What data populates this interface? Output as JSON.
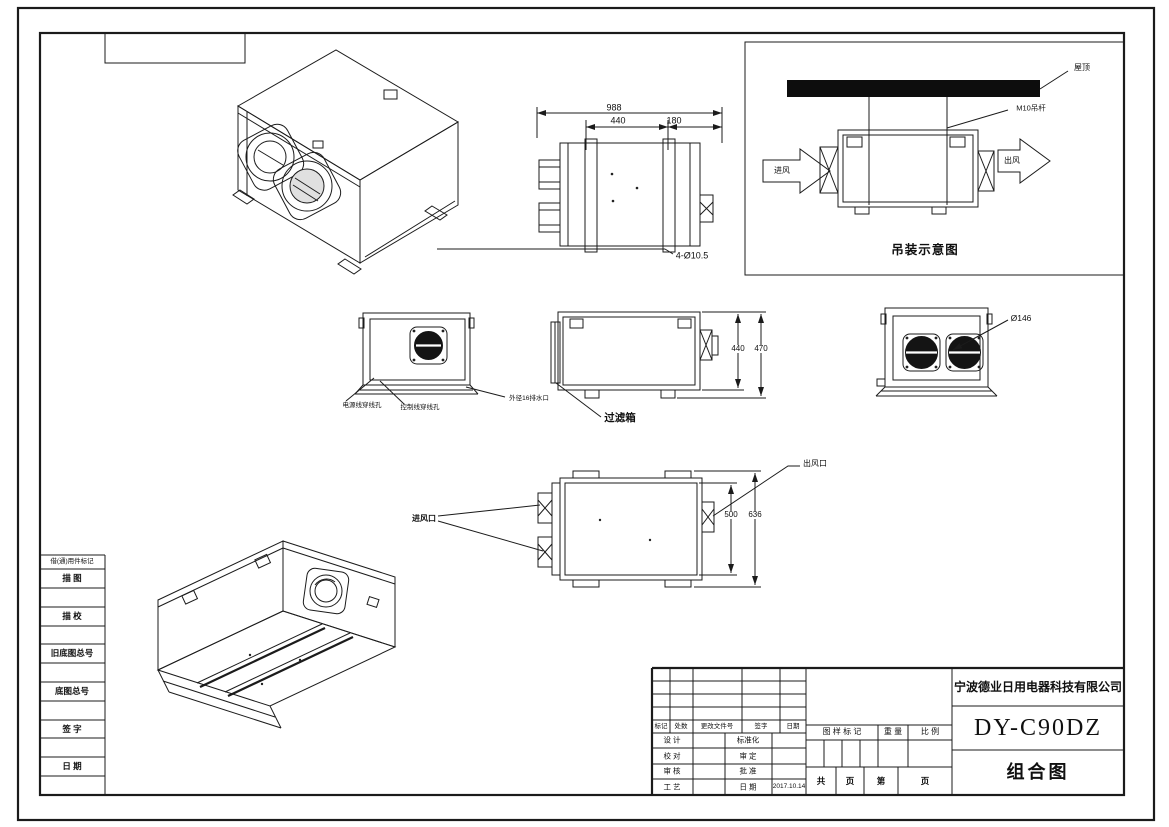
{
  "sheet": {
    "background": "#ffffff",
    "ink": "#1b1b1b"
  },
  "top_view": {
    "dim_overall": "988",
    "dim_body": "440",
    "dim_end": "180",
    "hole_callout": "4-Ø10.5"
  },
  "hanging_diagram": {
    "caption": "吊装示意图",
    "roof_label": "屋顶",
    "rod_label": "M10吊杆",
    "inlet_label": "进风",
    "outlet_label": "出风"
  },
  "front_view_labels": {
    "power_hole": "电源线穿线孔",
    "control_hole": "控制线穿线孔",
    "drain": "外径16排水口"
  },
  "side_view": {
    "dim_body": "440",
    "dim_overall": "470",
    "filter_box": "过滤箱"
  },
  "rear_view": {
    "port_diameter": "Ø146"
  },
  "plan_view": {
    "inlet_label": "进风口",
    "outlet_label": "出风口",
    "dim_body": "500",
    "dim_overall": "636"
  },
  "left_margin": {
    "rows": [
      "借(通)用件标记",
      "描  图",
      "描  校",
      "旧底图总号",
      "底图总号",
      "签  字",
      "日  期"
    ]
  },
  "title_block": {
    "revision_header": {
      "mark": "标记",
      "count": "处数",
      "doc_no": "更改文件号",
      "sign": "签字",
      "date": "日期"
    },
    "approval_rows": [
      {
        "left": "设 计",
        "right": "标准化",
        "value": ""
      },
      {
        "left": "校 对",
        "right": "审 定",
        "value": ""
      },
      {
        "left": "审 核",
        "right": "批 准",
        "value": ""
      },
      {
        "left": "工 艺",
        "right": "日 期",
        "value": "2017.10.14"
      }
    ],
    "stamp_header": {
      "mark": "图 样 标 记",
      "weight": "重 量",
      "scale": "比 例"
    },
    "pages": {
      "total_label": "共",
      "total_unit": "页",
      "index_label": "第",
      "index_unit": "页"
    },
    "company": "宁波德业日用电器科技有限公司",
    "model": "DY-C90DZ",
    "drawing_name": "组合图"
  }
}
